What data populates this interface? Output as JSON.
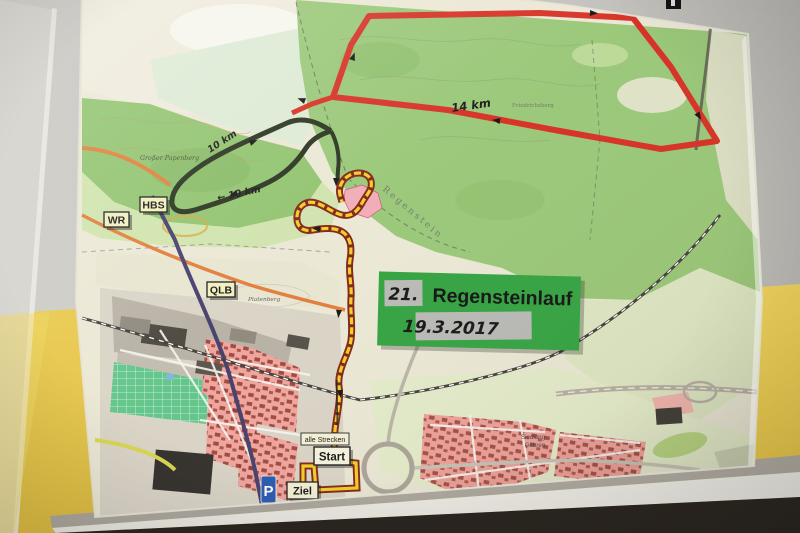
{
  "sign": {
    "number": "21.",
    "title": "Regensteinlauf",
    "date": "19.3.2017"
  },
  "stations": {
    "hbs": "HBS",
    "wr": "WR",
    "qlb": "QLB"
  },
  "course": {
    "all_tracks": "alle Strecken",
    "start": "Start",
    "finish": "Ziel",
    "parking": "P",
    "red_distance": "14 km",
    "black_distance_upper": "10 km",
    "black_distance_lower": "← 10 km"
  },
  "places": {
    "papenberg": "Großer Papenberg",
    "regenstein": "Regenstein",
    "platenberg": "Platenberg",
    "friedrichsberg": "Friedrichsberg",
    "siedlung_line1": "Siedlung",
    "siedlung_line2": "Gehren"
  },
  "colors": {
    "sign_green": "#2ea13c",
    "route_red": "#d62b1f",
    "route_dark": "#232e19",
    "route_yellow": "#f2cc1f",
    "route_casing": "#7e2012",
    "parking_blue": "#2456ae",
    "wall_yellow": "#e7c84f",
    "wall_grey": "#c6c4bf",
    "label_bg": "#f4f1d4"
  }
}
